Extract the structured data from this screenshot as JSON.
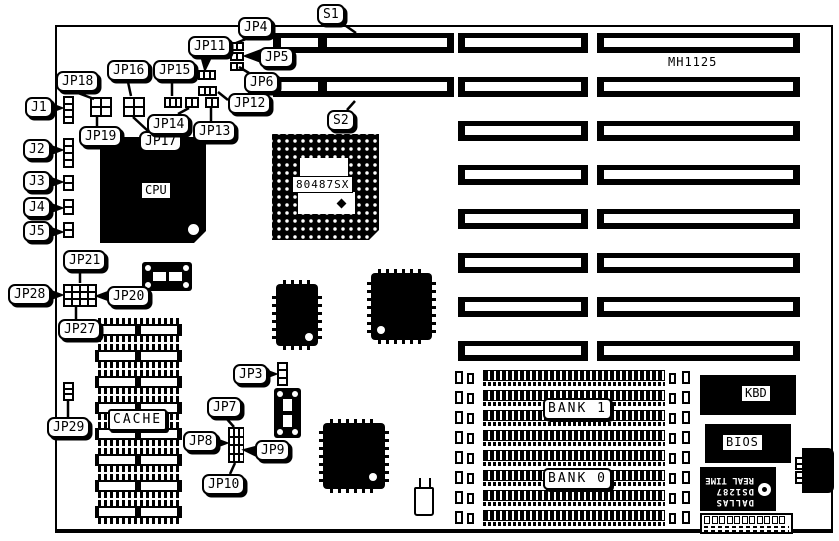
{
  "board": {
    "part_number": "MH1125"
  },
  "chips": {
    "cpu": "CPU",
    "coprocessor": "80487SX",
    "cache": "CACHE",
    "keyboard_controller": "KBD",
    "bios": "BIOS"
  },
  "rtc": {
    "brand": "DALLAS",
    "model": "DS1287",
    "type": "REAL TIME"
  },
  "memory": {
    "bank1": "BANK 1",
    "bank0": "BANK 0"
  },
  "callouts": [
    {
      "id": "s1",
      "label": "S1",
      "x": 317,
      "y": 4,
      "leader": [
        346,
        26,
        356,
        33
      ],
      "arrow": false
    },
    {
      "id": "jp4",
      "label": "JP4",
      "x": 238,
      "y": 17,
      "leader": [
        246,
        39,
        236,
        43
      ],
      "arrow": false
    },
    {
      "id": "jp11",
      "label": "JP11",
      "x": 188,
      "y": 36,
      "leader": [
        206,
        58,
        205,
        69
      ],
      "arrow": true
    },
    {
      "id": "jp5",
      "label": "JP5",
      "x": 259,
      "y": 47,
      "leader": [
        258,
        56,
        246,
        56
      ],
      "arrow": true
    },
    {
      "id": "jp6",
      "label": "JP6",
      "x": 244,
      "y": 72,
      "leader": [
        249,
        73,
        239,
        67
      ],
      "arrow": false
    },
    {
      "id": "jp16",
      "label": "JP16",
      "x": 107,
      "y": 60,
      "leader": [
        128,
        82,
        131,
        96
      ],
      "arrow": false
    },
    {
      "id": "jp15",
      "label": "JP15",
      "x": 153,
      "y": 60,
      "leader": [
        172,
        82,
        172,
        96
      ],
      "arrow": false
    },
    {
      "id": "jp18",
      "label": "JP18",
      "x": 56,
      "y": 71,
      "leader": [
        78,
        93,
        94,
        99
      ],
      "arrow": false
    },
    {
      "id": "jp12",
      "label": "JP12",
      "x": 228,
      "y": 93,
      "leader": [
        228,
        100,
        218,
        92
      ],
      "arrow": false
    },
    {
      "id": "j1",
      "label": "J1",
      "x": 25,
      "y": 97,
      "leader": [
        52,
        108,
        61,
        108
      ],
      "arrow": true
    },
    {
      "id": "jp19",
      "label": "JP19",
      "x": 79,
      "y": 126,
      "leader": [
        97,
        126,
        97,
        117
      ],
      "arrow": false
    },
    {
      "id": "jp17",
      "label": "JP17",
      "x": 139,
      "y": 131,
      "leader": [
        148,
        131,
        133,
        117
      ],
      "arrow": false
    },
    {
      "id": "jp14",
      "label": "JP14",
      "x": 147,
      "y": 114,
      "leader": [
        178,
        114,
        189,
        108
      ],
      "arrow": false
    },
    {
      "id": "jp13",
      "label": "JP13",
      "x": 193,
      "y": 121,
      "leader": [
        211,
        121,
        211,
        108
      ],
      "arrow": false
    },
    {
      "id": "s2",
      "label": "S2",
      "x": 327,
      "y": 110,
      "leader": [
        347,
        110,
        355,
        101
      ],
      "arrow": false
    },
    {
      "id": "j2",
      "label": "J2",
      "x": 23,
      "y": 139,
      "leader": [
        52,
        150,
        61,
        150
      ],
      "arrow": true
    },
    {
      "id": "j3",
      "label": "J3",
      "x": 23,
      "y": 171,
      "leader": [
        52,
        182,
        61,
        182
      ],
      "arrow": true
    },
    {
      "id": "j4",
      "label": "J4",
      "x": 23,
      "y": 197,
      "leader": [
        52,
        208,
        61,
        208
      ],
      "arrow": true
    },
    {
      "id": "j5",
      "label": "J5",
      "x": 23,
      "y": 221,
      "leader": [
        52,
        232,
        61,
        232
      ],
      "arrow": true
    },
    {
      "id": "jp21",
      "label": "JP21",
      "x": 63,
      "y": 250,
      "leader": [
        80,
        271,
        80,
        283
      ],
      "arrow": false
    },
    {
      "id": "jp28",
      "label": "JP28",
      "x": 8,
      "y": 284,
      "leader": [
        52,
        295,
        61,
        295
      ],
      "arrow": true
    },
    {
      "id": "jp20",
      "label": "JP20",
      "x": 107,
      "y": 286,
      "leader": [
        107,
        296,
        98,
        296
      ],
      "arrow": true
    },
    {
      "id": "jp27",
      "label": "JP27",
      "x": 58,
      "y": 319,
      "leader": [
        76,
        319,
        76,
        307
      ],
      "arrow": false
    },
    {
      "id": "jp3",
      "label": "JP3",
      "x": 233,
      "y": 364,
      "leader": [
        268,
        374,
        275,
        374
      ],
      "arrow": true
    },
    {
      "id": "jp29",
      "label": "JP29",
      "x": 47,
      "y": 417,
      "leader": [
        68,
        417,
        68,
        401
      ],
      "arrow": false
    },
    {
      "id": "jp7",
      "label": "JP7",
      "x": 207,
      "y": 397,
      "leader": [
        226,
        418,
        234,
        427
      ],
      "arrow": false
    },
    {
      "id": "jp8",
      "label": "JP8",
      "x": 183,
      "y": 431,
      "leader": [
        220,
        443,
        226,
        443
      ],
      "arrow": true
    },
    {
      "id": "jp9",
      "label": "JP9",
      "x": 255,
      "y": 440,
      "leader": [
        255,
        451,
        245,
        450
      ],
      "arrow": true
    },
    {
      "id": "jp10",
      "label": "JP10",
      "x": 202,
      "y": 474,
      "leader": [
        230,
        474,
        235,
        463
      ],
      "arrow": false
    }
  ],
  "expansion_slot_labels": {
    "slot1": "S1",
    "slot2": "S2"
  }
}
